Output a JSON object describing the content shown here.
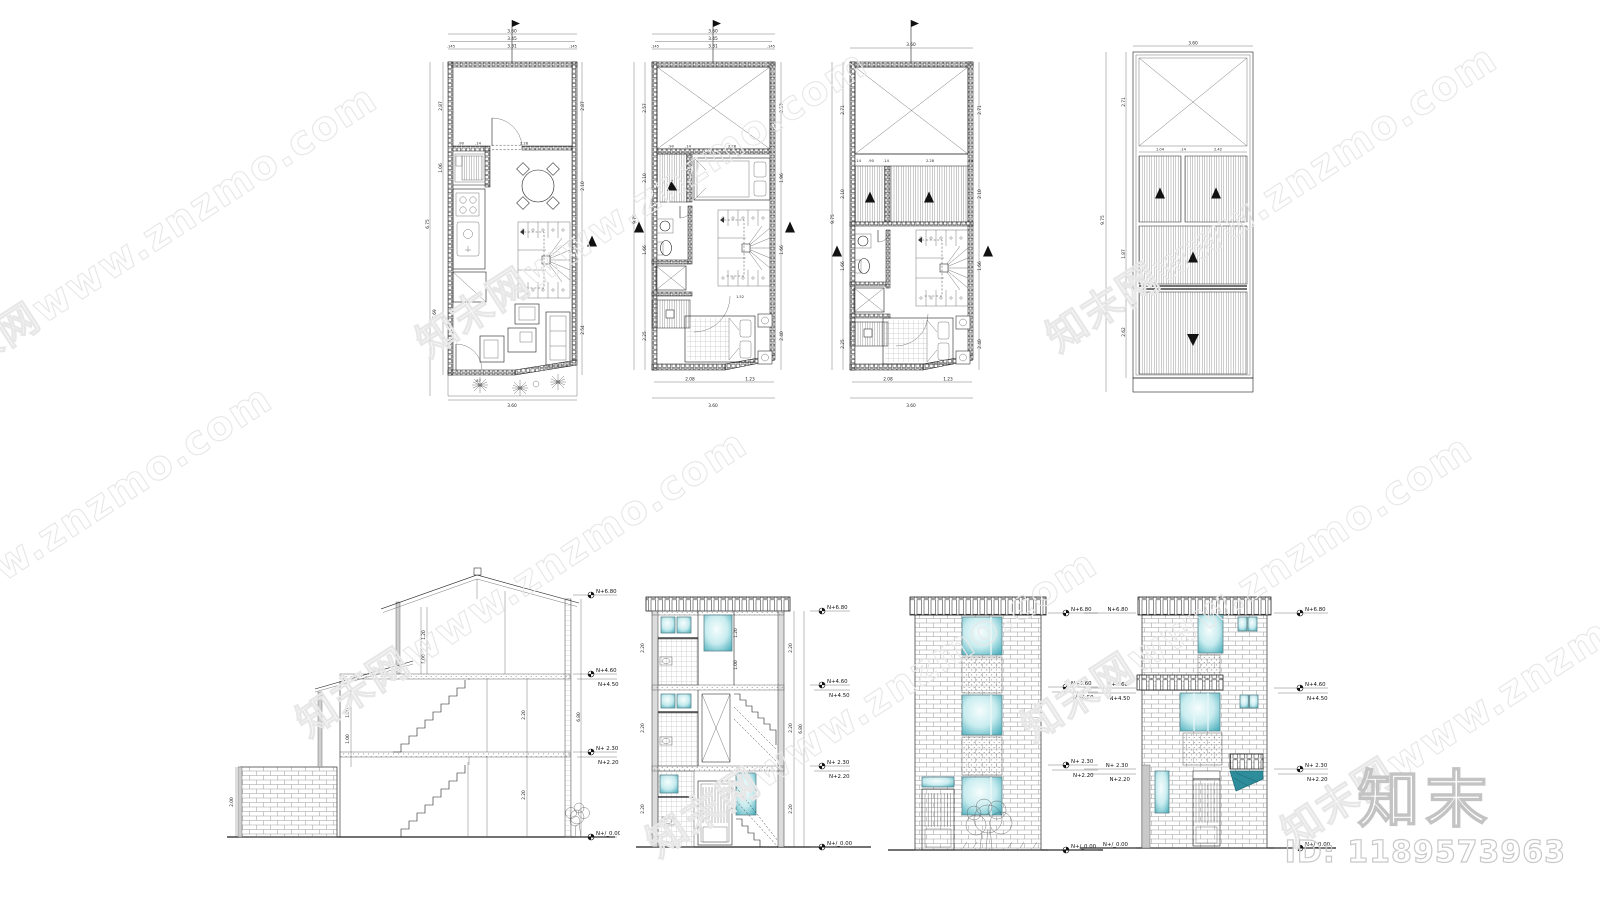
{
  "watermark": {
    "text": "知末网www.znzmo.com"
  },
  "brand": {
    "logo": "知末",
    "id": "ID: 1189573963"
  },
  "levels": {
    "a": "N+6.80",
    "b": "N+4.60",
    "c": "N+4.50",
    "d": "N+ 2.30",
    "e": "N+2.20",
    "f": "N+/_0.00"
  },
  "plan1": {
    "top1": "3.60",
    "top2": "3.45",
    "top3l": ".145",
    "top3m": "3.31",
    "top3r": ".145",
    "l1": "2.87",
    "l2": "1.06",
    "l3": "6.75",
    "l4": "5.69",
    "r1": "2.87",
    "r2": "2.10",
    "r3": "2.54",
    "m1": ".90",
    "m2": ".14",
    "m3": "2.28",
    "g1": ".87",
    "b1": "3.60"
  },
  "plan2": {
    "top1": "3.60",
    "top2": "3.45",
    "top3l": ".145",
    "top3m": "3.31",
    "top3r": ".145",
    "l1": "2.57",
    "l2": "2.10",
    "l3": "1.66",
    "l4": "2.25",
    "l5": "9.75",
    "r1": "2.57",
    "r2": "1.96",
    "r3": "1.66",
    "r4": "2.40",
    "m1": ".90",
    "m2": ".14",
    "m3": "2.28",
    "m4": "1.52",
    "b1": "2.08",
    "b2": "1.23",
    "b3": "3.60"
  },
  "plan3": {
    "top1": "3.60",
    "l1": "2.71",
    "l2": "2.10",
    "l3": "1.66",
    "l4": "2.25",
    "l5": "9.75",
    "r1": "2.71",
    "r2": "2.10",
    "r3": "1.66",
    "r4": "2.40",
    "m1": ".90",
    "m2": ".14",
    "m3": "2.28",
    "b1": "2.08",
    "b2": "1.23",
    "b3": "3.60"
  },
  "plan4": {
    "top1": "3.60",
    "l1": "2.71",
    "l2": "9.75",
    "l3": "1.87",
    "l4": "2.62",
    "m1": "1.04",
    "m2": ".14",
    "m3": "2.42"
  },
  "secA": {
    "d1": "2.00",
    "d2": "1.20",
    "d3": "1.00",
    "d4": "2.20",
    "d5": "2.20",
    "d6": "6.80",
    "d7": "1.20",
    "d8": "1.00"
  },
  "secB": {
    "d1": "2.20",
    "d2": "2.20",
    "d3": "2.20",
    "d4": "6.80",
    "d5": "1.20",
    "d6": "1.00"
  }
}
